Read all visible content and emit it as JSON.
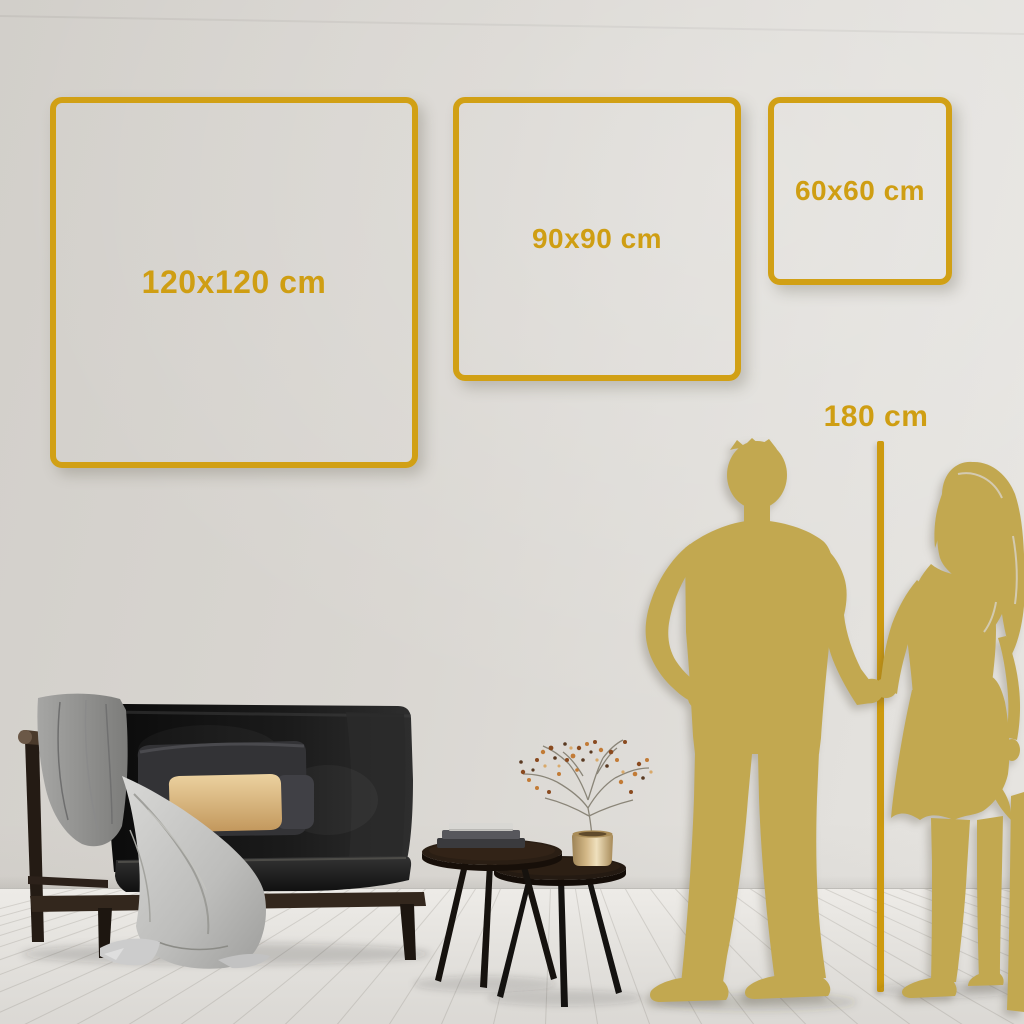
{
  "size_guide": {
    "unit": "cm",
    "options": [
      {
        "label": "120x120 cm",
        "width_cm": 120,
        "height_cm": 120
      },
      {
        "label": "90x90 cm",
        "width_cm": 90,
        "height_cm": 90
      },
      {
        "label": "60x60 cm",
        "width_cm": 60,
        "height_cm": 60
      }
    ],
    "person_height_reference": {
      "label": "180 cm",
      "height_cm": 180
    }
  },
  "colors": {
    "accent_gold": "#d1a015",
    "label_gold": "#cf9e13",
    "silhouette_gold": "#c2a850",
    "wall": "#d9d6d1",
    "floor": "#edebe7"
  },
  "scene_items": [
    "man-silhouette",
    "woman-silhouette",
    "sofa",
    "throw-blanket",
    "back-cushion",
    "beige-pillow",
    "nesting-coffee-tables",
    "books-stack",
    "brass-vase",
    "berry-branch-plant"
  ]
}
